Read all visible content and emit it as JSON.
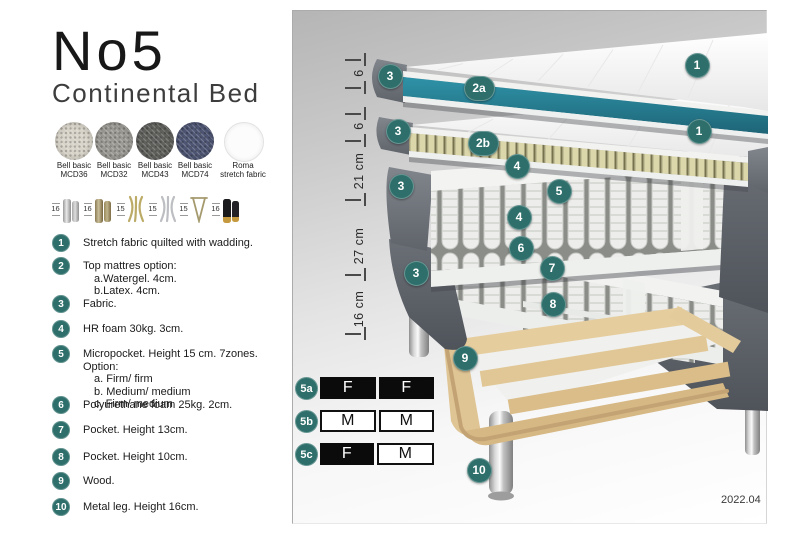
{
  "header": {
    "title": "No5",
    "subtitle": "Continental Bed"
  },
  "fabrics": {
    "items": [
      {
        "line1": "Bell basic",
        "line2": "MCD36",
        "color": "#d8d4c9"
      },
      {
        "line1": "Bell basic",
        "line2": "MCD32",
        "color": "#9c9a94"
      },
      {
        "line1": "Bell basic",
        "line2": "MCD43",
        "color": "#60615d"
      },
      {
        "line1": "Bell basic",
        "line2": "MCD74",
        "color": "#4e5674"
      },
      {
        "line1": "Roma",
        "line2": "stretch fabric",
        "color": "#fcfcfc"
      }
    ]
  },
  "leg_options": {
    "items": [
      {
        "height": "16",
        "icon": "cylinder-silver-legs"
      },
      {
        "height": "16",
        "icon": "cylinder-bronze-legs"
      },
      {
        "height": "15",
        "icon": "curved-gold-legs"
      },
      {
        "height": "15",
        "icon": "curved-silver-legs"
      },
      {
        "height": "15",
        "icon": "hairpin-metal-leg"
      },
      {
        "height": "16",
        "icon": "black-gold-tip-legs"
      }
    ]
  },
  "parts": [
    {
      "num": "1",
      "text": "Stretch fabric quilted with wadding.",
      "subs": []
    },
    {
      "num": "2",
      "text": "Top mattres option:",
      "subs": [
        "a.Watergel. 4cm.",
        "b.Latex. 4cm."
      ]
    },
    {
      "num": "3",
      "text": "Fabric.",
      "subs": []
    },
    {
      "num": "4",
      "text": "HR foam 30kg. 3cm.",
      "subs": []
    },
    {
      "num": "5",
      "text": "Micropocket. Height 15 cm. 7zones. Option:",
      "subs": [
        "a. Firm/ firm",
        "b. Medium/ medium",
        "c. Firm/ medium"
      ]
    },
    {
      "num": "6",
      "text": "Polyurethane foam 25kg. 2cm.",
      "subs": []
    },
    {
      "num": "7",
      "text": "Pocket. Height 13cm.",
      "subs": []
    },
    {
      "num": "8",
      "text": "Pocket. Height 10cm.",
      "subs": []
    },
    {
      "num": "9",
      "text": "Wood.",
      "subs": []
    },
    {
      "num": "10",
      "text": "Metal leg. Height 16cm.",
      "subs": []
    }
  ],
  "diagram": {
    "dimensions": [
      {
        "label": "6"
      },
      {
        "label": "6"
      },
      {
        "label": "21 cm"
      },
      {
        "label": "27 cm"
      },
      {
        "label": "16 cm"
      }
    ],
    "callouts": [
      {
        "label": "3"
      },
      {
        "label": "2a"
      },
      {
        "label": "1"
      },
      {
        "label": "3"
      },
      {
        "label": "2b"
      },
      {
        "label": "1"
      },
      {
        "label": "4"
      },
      {
        "label": "5"
      },
      {
        "label": "3"
      },
      {
        "label": "4"
      },
      {
        "label": "6"
      },
      {
        "label": "7"
      },
      {
        "label": "3"
      },
      {
        "label": "8"
      },
      {
        "label": "9"
      },
      {
        "label": "10"
      }
    ],
    "firmness": {
      "rows": [
        {
          "id": "5a",
          "cell1": "F",
          "cell1_style": "dark",
          "cell2": "F",
          "cell2_style": "dark"
        },
        {
          "id": "5b",
          "cell1": "M",
          "cell1_style": "light",
          "cell2": "M",
          "cell2_style": "light"
        },
        {
          "id": "5c",
          "cell1": "F",
          "cell1_style": "dark",
          "cell2": "M",
          "cell2_style": "light"
        }
      ]
    },
    "version": "2022.04"
  },
  "colors": {
    "badge_teal": "#2e6f6b",
    "topper_teal": "#27808f",
    "fabric_gray": "#6d7177",
    "wood": "#e2cb9c"
  }
}
